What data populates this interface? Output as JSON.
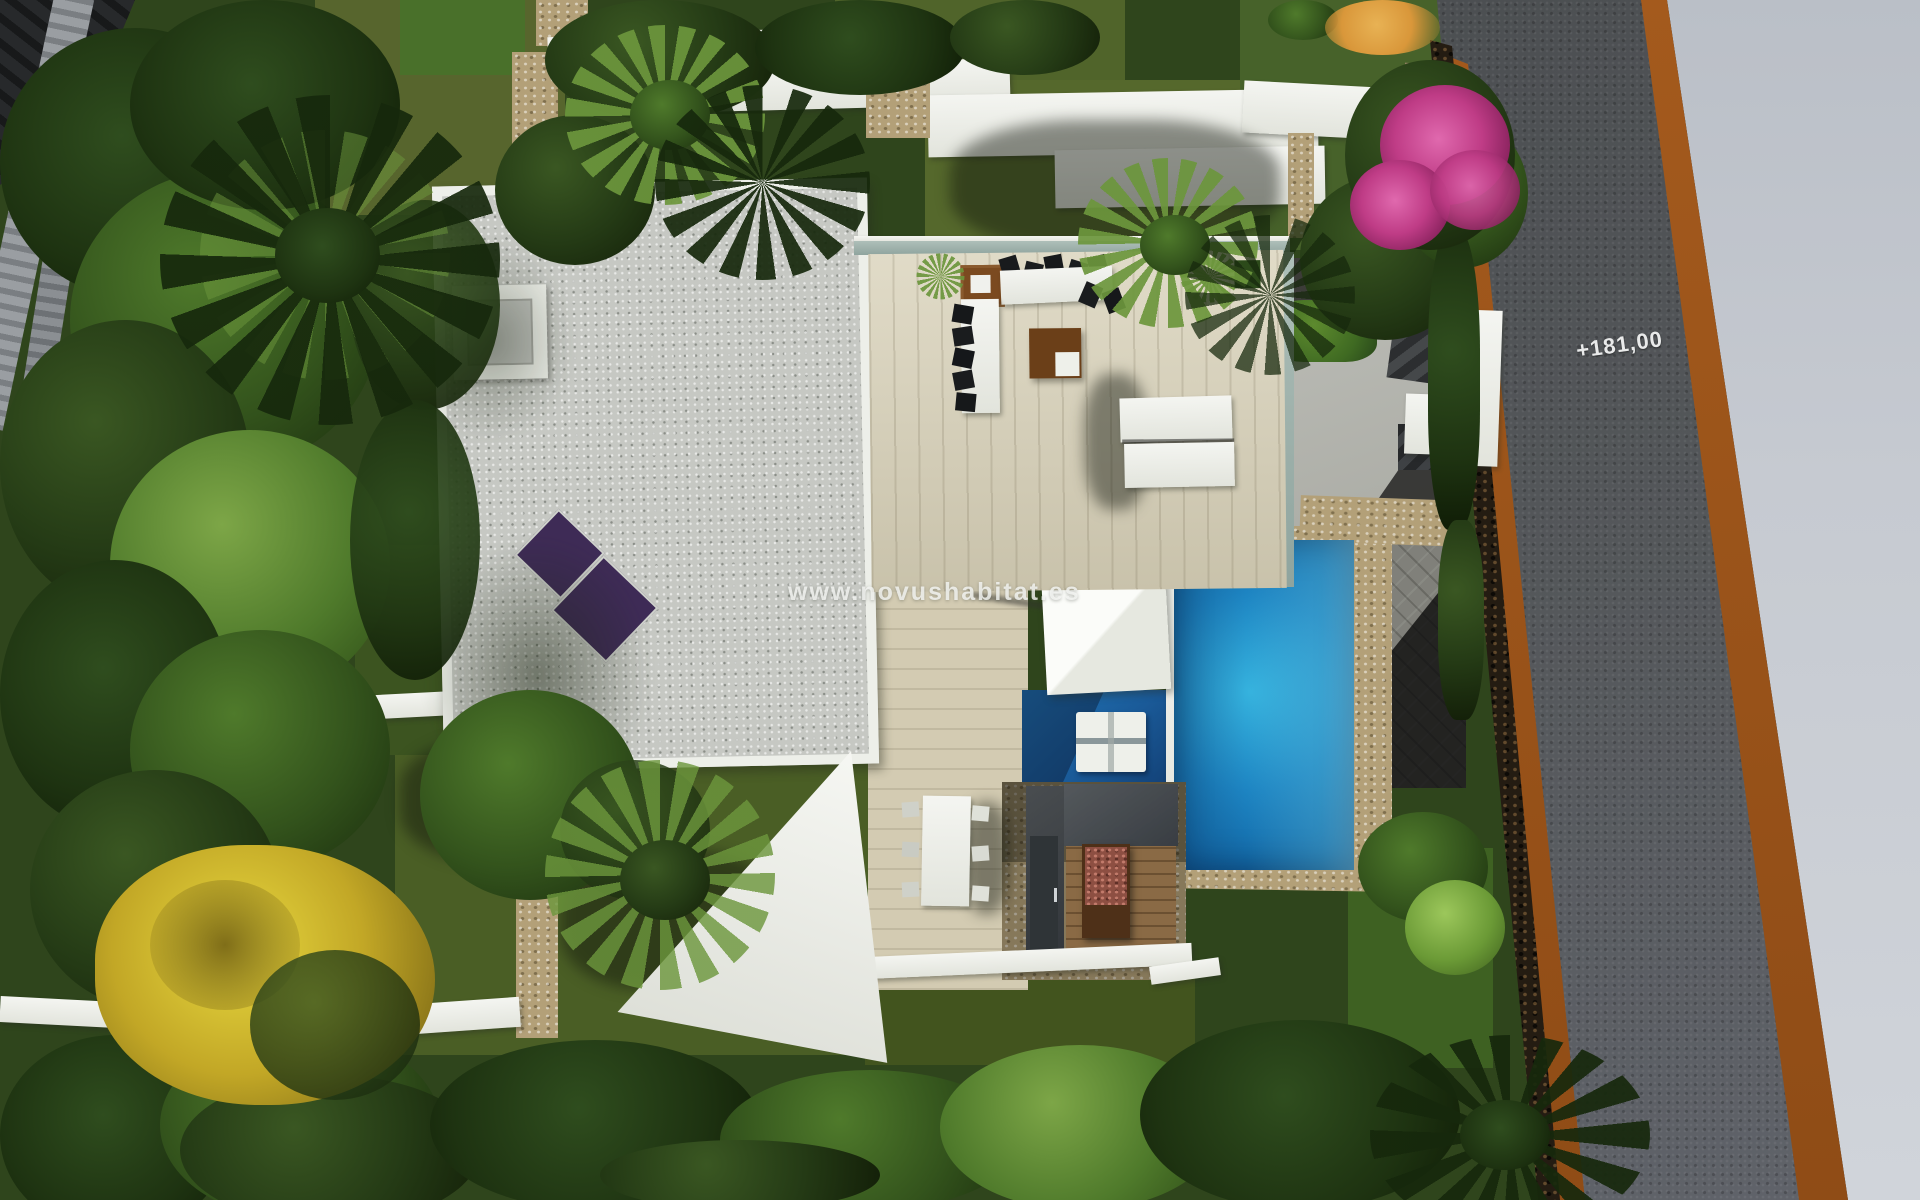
{
  "watermark": {
    "text": "www.novushabitat.es"
  },
  "road": {
    "elevation_label": "+181,00"
  },
  "colors": {
    "pool_light": "#35b2de",
    "pool_mid": "#1d84c2",
    "pool_dark": "#0f5f9e",
    "spa_blue": "#1a5a98",
    "road_asphalt": "#54575a",
    "shoulder_orange": "#a45a1d",
    "sidewalk": "#c6cad1",
    "roof_gravel": "#c6c8c3",
    "parapet_white": "#edefe9",
    "deck_wood": "#d8d1b8",
    "solar_purple": "#3e2b56",
    "stone_beige": "#b3a078",
    "grass_olive": "#55682c",
    "grass_dark": "#3e5420",
    "tree_dark": "#1d2e10",
    "tree_mid": "#33521d",
    "tree_light": "#5d8033",
    "yellow_tree": "#c2a726",
    "bougainvillea": "#bf3c86",
    "white_structure": "#f2f3ef",
    "glass_teal": "#8fa49e"
  }
}
